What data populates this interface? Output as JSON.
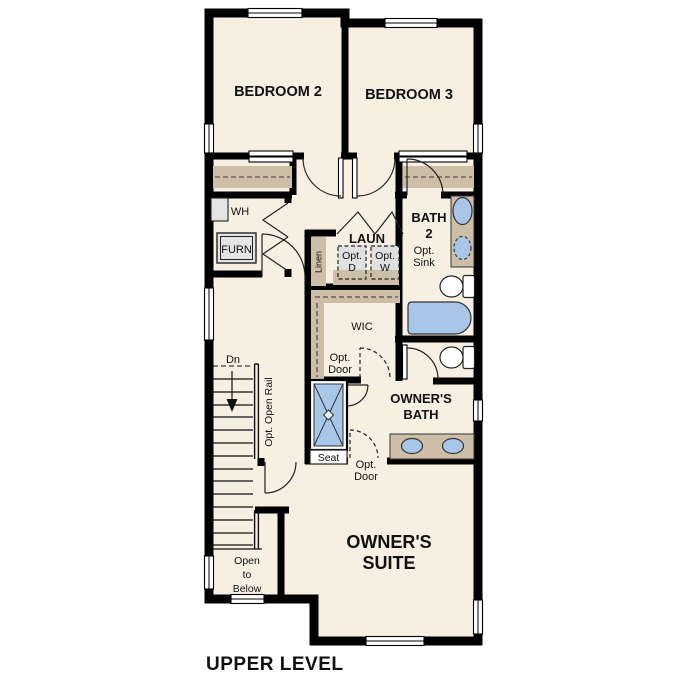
{
  "title": "UPPER LEVEL",
  "rooms": {
    "bedroom2": "BEDROOM 2",
    "bedroom3": "BEDROOM 3",
    "laundry": "LAUN",
    "bath2_l1": "BATH",
    "bath2_l2": "2",
    "wic": "WIC",
    "owners_bath_l1": "OWNER'S",
    "owners_bath_l2": "BATH",
    "owners_suite_l1": "OWNER'S",
    "owners_suite_l2": "SUITE",
    "open_below_l1": "Open",
    "open_below_l2": "to",
    "open_below_l3": "Below"
  },
  "labels": {
    "wh": "WH",
    "furn": "FURN",
    "linen": "Linen",
    "seat": "Seat",
    "dn": "Dn",
    "opt_open_rail": "Opt. Open Rail"
  },
  "optional": {
    "prefix": "Opt.",
    "dryer": "D",
    "washer": "W",
    "sink": "Sink",
    "door": "Door"
  },
  "colors": {
    "wall": "#000000",
    "floor": "#f7efe2",
    "shelf": "#cdbfa7",
    "fixture_blue": "#a8c6e7",
    "appliance_gray": "#e4e4e4",
    "background": "#ffffff"
  }
}
